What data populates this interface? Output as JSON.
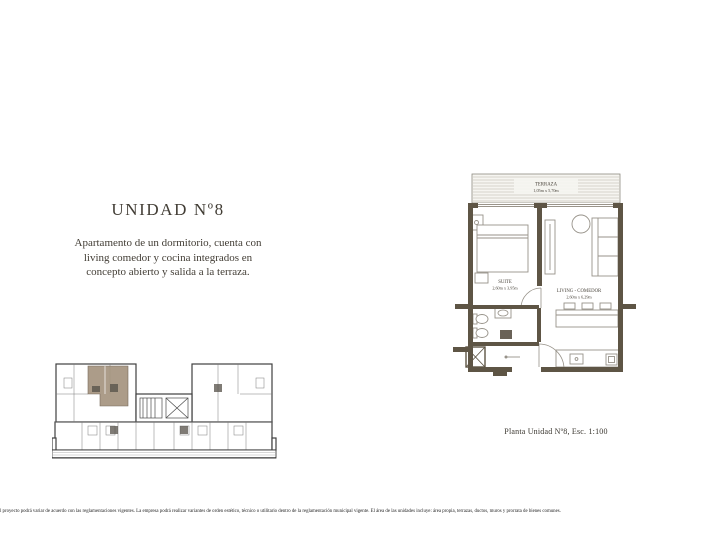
{
  "text_block": {
    "title": "UNIDAD Nº8",
    "description_lines": [
      "Apartamento de un dormitorio, cuenta con",
      "living comedor y cocina integrados en",
      "concepto abierto y salida a la terraza."
    ]
  },
  "main_plan": {
    "caption": "Planta Unidad Nº8, Esc. 1:100",
    "rooms": {
      "terraza": {
        "name": "TERRAZA",
        "dims": "1,05m x 5,70m"
      },
      "suite": {
        "name": "SUITE",
        "dims": "2,60m x 3,95m"
      },
      "living": {
        "name": "LIVING - COMEDOR",
        "dims": "2,60m x 6,29m"
      }
    },
    "colors": {
      "wall": "#5e5545",
      "furniture": "#979289"
    }
  },
  "overview_plan": {
    "highlight_color": "#a5947f"
  },
  "footer": {
    "disclaimer": "l proyecto podrá variar de acuerdo con las reglamentaciones vigentes. La empresa podrá realizar variantes de orden estético, técnico o utilitario dentro de la reglamentación municipal vigente. El área de las unidades incluye: área propia, terrazas, ductos, muros y prorrata de bienes comunes."
  }
}
